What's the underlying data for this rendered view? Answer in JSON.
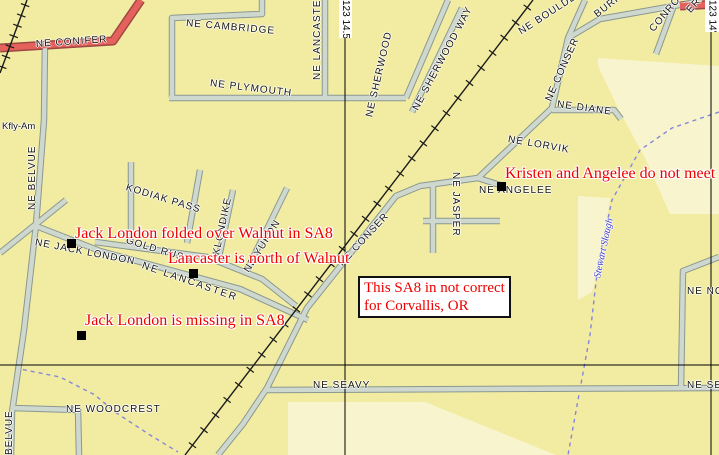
{
  "map": {
    "colors": {
      "background": "#F2ECA2",
      "region": "#F8F4CE",
      "street_casing": "#8A9890",
      "street_fill": "#CFD8CF",
      "major_casing": "#9E4744",
      "major_fill": "#E5625C",
      "railroad": "#1A1A1A",
      "graticule": "#000000",
      "stream": "#8585DC",
      "stream_label": "#3A3ACF",
      "marker": "#000000",
      "annotation": "#EE0000",
      "street_label": "#141414"
    },
    "regions": [
      {
        "id": "region-northeast",
        "points": "598,58 719,66 719,214 670,214 646,160 618,108 598,66"
      },
      {
        "id": "region-slough-west",
        "points": "578,196 610,198 601,260 592,292 578,300"
      },
      {
        "id": "region-southeast",
        "points": "288,402 425,402 556,455 288,455"
      }
    ],
    "streams": [
      {
        "id": "stewart-slough",
        "points": "719,112 672,128 640,150 612,200 598,265 590,335 578,400 568,455"
      },
      {
        "id": "stream-southwest",
        "points": "15,368 60,377 95,395 115,412 150,435 178,452"
      }
    ],
    "streets": [
      {
        "id": "ne-cambridge",
        "type": "road",
        "points": "172,98 172,18 262,14 262,0"
      },
      {
        "id": "ne-lancaster-north",
        "type": "road",
        "points": "325,0 325,96"
      },
      {
        "id": "ne-plymouth",
        "type": "road",
        "points": "169,98 406,98"
      },
      {
        "id": "ne-sherwood",
        "type": "road",
        "points": "406,98 448,0"
      },
      {
        "id": "ne-sherwood-way",
        "type": "road",
        "points": "412,112 462,8"
      },
      {
        "id": "ne-belvue",
        "type": "road",
        "points": "45,42 44,120 36,225 24,330 12,412 11,455"
      },
      {
        "id": "west-diagonal",
        "type": "road",
        "points": "0,253 66,200"
      },
      {
        "id": "ne-jack-london-lancaster",
        "type": "road",
        "points": "36,226 100,251 240,289 308,320"
      },
      {
        "id": "gold-rush",
        "type": "road",
        "points": "95,242 207,257 262,279 296,306"
      },
      {
        "id": "kodiak-pass-west",
        "type": "road",
        "points": "131,162 131,245"
      },
      {
        "id": "kodiak-pass-east",
        "type": "road",
        "points": "200,170 187,243"
      },
      {
        "id": "klondike",
        "type": "road",
        "points": "233,190 218,262"
      },
      {
        "id": "ne-yukon",
        "type": "road",
        "points": "287,188 246,272"
      },
      {
        "id": "ne-conser",
        "type": "road",
        "points": "585,0 568,38 552,108 478,178 420,186 396,196 307,308 267,388 243,424 218,455"
      },
      {
        "id": "ne-diane",
        "type": "road",
        "points": "552,110 614,110 621,119"
      },
      {
        "id": "burke",
        "type": "road",
        "points": "568,38 600,19 702,1"
      },
      {
        "id": "conroy",
        "type": "road",
        "points": "673,8 656,54"
      },
      {
        "id": "ne-angelee",
        "type": "road",
        "points": "478,178 503,186"
      },
      {
        "id": "ne-jasper-v",
        "type": "road",
        "points": "433,186 433,253"
      },
      {
        "id": "ne-jasper-h",
        "type": "road",
        "points": "423,221 500,221"
      },
      {
        "id": "ne-seavy",
        "type": "road",
        "points": "267,390 719,388"
      },
      {
        "id": "ne-norwood",
        "type": "road",
        "points": "719,257 683,271 681,389"
      },
      {
        "id": "ne-woodcrest",
        "type": "road",
        "points": "12,408 78,410 79,455"
      },
      {
        "id": "ne-conifer",
        "type": "major",
        "points": "0,48 113,41 141,0"
      },
      {
        "id": "ne-conifer-northeast",
        "type": "major",
        "points": "680,6 719,4"
      }
    ],
    "railroads": [
      {
        "id": "railroad-main",
        "points": "533,0 185,455",
        "step": 19
      },
      {
        "id": "railroad-northwest",
        "points": "27,0 0,73",
        "step": 11
      }
    ],
    "graticule": {
      "vlines": [
        {
          "x": 345
        },
        {
          "x": 711
        }
      ],
      "hlines": [
        {
          "y": 365
        }
      ],
      "label_boxes": [
        {
          "t": "123 14.5'",
          "x": 339,
          "y": 0,
          "w": 13,
          "h": 38
        },
        {
          "t": "123 14'",
          "x": 705,
          "y": 0,
          "w": 14,
          "h": 32
        }
      ]
    },
    "street_labels": [
      {
        "id": "ne-conifer",
        "t": "NE CONIFER",
        "x": 36,
        "y": 45,
        "r": -4
      },
      {
        "id": "ne-cambridge",
        "t": "NE CAMBRIDGE",
        "x": 186,
        "y": 24,
        "r": 5
      },
      {
        "id": "ne-lancaster-north",
        "t": "NE LANCASTER",
        "x": 318,
        "y": 80,
        "r": -90
      },
      {
        "id": "ne-plymouth",
        "t": "NE PLYMOUTH",
        "x": 210,
        "y": 84,
        "r": 7
      },
      {
        "id": "ne-sherwood",
        "t": "NE SHERWOOD",
        "x": 370,
        "y": 117,
        "r": -77
      },
      {
        "id": "ne-sherwood-way",
        "t": "NE SHERWOOD WAY",
        "x": 416,
        "y": 110,
        "r": -62
      },
      {
        "id": "ne-boulder",
        "t": "NE BOULDER",
        "x": 520,
        "y": 33,
        "r": -33
      },
      {
        "id": "burke",
        "t": "BURKE",
        "x": 596,
        "y": 16,
        "r": -38
      },
      {
        "id": "conroy",
        "t": "CONROY",
        "x": 652,
        "y": 31,
        "r": -50
      },
      {
        "id": "ne-conser-north",
        "t": "NE CONSER",
        "x": 549,
        "y": 101,
        "r": -66
      },
      {
        "id": "ne-diane",
        "t": "NE DIANE",
        "x": 557,
        "y": 105,
        "r": 8
      },
      {
        "id": "ne-lorvik",
        "t": "NE LORVIK",
        "x": 508,
        "y": 140,
        "r": 10
      },
      {
        "id": "ne-angelee",
        "t": "NE ANGELEE",
        "x": 479,
        "y": 191,
        "r": 0
      },
      {
        "id": "ne-jasper",
        "t": "NE JASPER",
        "x": 455,
        "y": 172,
        "r": 90
      },
      {
        "id": "ne-conser-south",
        "t": "NE CONSER",
        "x": 341,
        "y": 265,
        "r": -47
      },
      {
        "id": "kodiak-pass",
        "t": "KODIAK PASS",
        "x": 126,
        "y": 188,
        "r": 17
      },
      {
        "id": "klondike",
        "t": "KLONDIKE",
        "x": 217,
        "y": 255,
        "r": -78
      },
      {
        "id": "ne-yukon",
        "t": "NE YUKON",
        "x": 247,
        "y": 272,
        "r": -58
      },
      {
        "id": "gold-rush",
        "t": "GOLD RUSH",
        "x": 126,
        "y": 241,
        "r": 17
      },
      {
        "id": "ne-jack-london",
        "t": "NE JACK LONDON",
        "x": 35,
        "y": 243,
        "r": 11
      },
      {
        "id": "ne-lancaster-diag",
        "t": "NE LANCASTER",
        "x": 142,
        "y": 266,
        "r": 19,
        "spacing": 2
      },
      {
        "id": "ne-belvue",
        "t": "NE BELVUE",
        "x": 33,
        "y": 210,
        "r": -90
      },
      {
        "id": "belvue-south",
        "t": "BELVUE",
        "x": 10,
        "y": 455,
        "r": -90
      },
      {
        "id": "ne-woodcrest",
        "t": "NE WOODCREST",
        "x": 66,
        "y": 410,
        "r": 0
      },
      {
        "id": "ne-seavy-west",
        "t": "NE SEAVY",
        "x": 313,
        "y": 386,
        "r": 0
      },
      {
        "id": "ne-seavy-east",
        "t": "NE SEAVY",
        "x": 687,
        "y": 386,
        "r": 0
      },
      {
        "id": "ne-no",
        "t": "NE NO",
        "x": 687,
        "y": 292,
        "r": 0
      },
      {
        "id": "kfly-am",
        "t": "Kfly-Am",
        "x": 2,
        "y": 127,
        "r": 0,
        "size": 9.5,
        "spacing": 0
      },
      {
        "id": "er-partial",
        "t": "ER",
        "x": 689,
        "y": 12,
        "r": -48
      },
      {
        "id": "stewart-slough",
        "t": "Stewart Slough",
        "x": 598,
        "y": 278,
        "r": -78,
        "color": "stream_label",
        "italic": true,
        "serif": true,
        "size": 10,
        "spacing": 0
      }
    ],
    "markers": [
      {
        "id": "marker-jack-london",
        "x": 67,
        "y": 239
      },
      {
        "id": "marker-lancaster",
        "x": 189,
        "y": 269
      },
      {
        "id": "marker-jack-london-missing",
        "x": 77,
        "y": 331
      },
      {
        "id": "marker-angelee",
        "x": 497,
        "y": 182
      }
    ],
    "annotations": [
      {
        "id": "annot-jack-london-folded",
        "t": "Jack London folded over Walnut in SA8",
        "x": 75,
        "y": 224
      },
      {
        "id": "annot-lancaster-north",
        "t": "Lancaster is north of Walnut",
        "x": 168,
        "y": 249
      },
      {
        "id": "annot-jack-london-missing",
        "t": "Jack London is missing in SA8",
        "x": 85,
        "y": 311
      },
      {
        "id": "annot-kristen-angelee",
        "t": "Kristen and Angelee do not meet",
        "x": 505,
        "y": 164
      }
    ],
    "note_box": {
      "x": 358,
      "y": 276,
      "w": 150,
      "lines": [
        "This SA8 in not correct",
        "for Corvallis, OR"
      ]
    }
  }
}
